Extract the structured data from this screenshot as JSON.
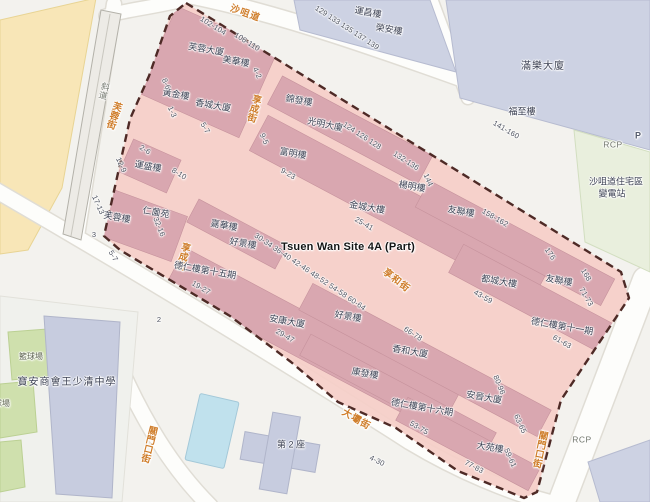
{
  "site": {
    "label": "Tsuen Wan Site 4A (Part)"
  },
  "colors": {
    "site_fill": "#f5cfc8",
    "site_parcel": "#d9a7b0",
    "site_border": "#4e2a26",
    "street_name": "#cf7d2a",
    "building_name": "#3d4254",
    "address_number": "#4e5360",
    "block_lavender": "#cdd2e3",
    "yellow_area": "#f8e6b7",
    "court_green": "#cfe0ad",
    "pool_blue": "#c0e1ed",
    "road_white": "#fdfdfb"
  },
  "labels": [
    {
      "n": "site-area-label",
      "t": "Tsuen Wan Site 4A (Part)",
      "x": 348,
      "y": 248,
      "r": 0,
      "c": "t"
    },
    {
      "n": "street-label-sha-tsui-road",
      "t": "沙咀道",
      "x": 245,
      "y": 14,
      "r": 20,
      "c": "s"
    },
    {
      "n": "street-label-fu-yung-street",
      "t": "芙蓉街",
      "x": 113,
      "y": 115,
      "r": 18,
      "c": "s",
      "v": true
    },
    {
      "n": "street-label-heung-shing-street-upper",
      "t": "享成街",
      "x": 253,
      "y": 108,
      "r": 15,
      "c": "s",
      "v": true
    },
    {
      "n": "street-label-heung-shing-street-lower",
      "t": "享成街",
      "x": 182,
      "y": 256,
      "r": 15,
      "c": "s",
      "v": true
    },
    {
      "n": "street-label-heung-wo-street",
      "t": "享和街",
      "x": 396,
      "y": 281,
      "r": 38,
      "c": "s"
    },
    {
      "n": "street-label-tai-pa-street",
      "t": "大壩街",
      "x": 356,
      "y": 420,
      "r": 30,
      "c": "s"
    },
    {
      "n": "street-label-kwan-mun-hau-street-west",
      "t": "關門口街",
      "x": 148,
      "y": 444,
      "r": 14,
      "c": "s",
      "v": true
    },
    {
      "n": "street-label-kwan-mun-hau-street-east",
      "t": "關門口街",
      "x": 539,
      "y": 449,
      "r": 12,
      "c": "s",
      "v": true
    },
    {
      "n": "building-label-fu-yung-mansion",
      "t": "芙蓉大廈",
      "x": 206,
      "y": 50,
      "r": 10,
      "c": "b"
    },
    {
      "n": "building-label-mei-wah-house",
      "t": "美華樓",
      "x": 236,
      "y": 62,
      "r": 10,
      "c": "b"
    },
    {
      "n": "building-label-wong-kam-house",
      "t": "黃金樓",
      "x": 176,
      "y": 95,
      "r": 10,
      "c": "b"
    },
    {
      "n": "building-label-heung-shing-mansion",
      "t": "香城大廈",
      "x": 213,
      "y": 106,
      "r": 10,
      "c": "b"
    },
    {
      "n": "building-label-kam-fat-house",
      "t": "錦發樓",
      "x": 299,
      "y": 101,
      "r": 10,
      "c": "b"
    },
    {
      "n": "building-label-kwong-ming-mansion",
      "t": "光明大廈",
      "x": 325,
      "y": 125,
      "r": 12,
      "c": "b"
    },
    {
      "n": "building-label-fu-ming-house",
      "t": "富明樓",
      "x": 293,
      "y": 154,
      "r": 10,
      "c": "b"
    },
    {
      "n": "building-label-yeung-ming-house",
      "t": "楊明樓",
      "x": 412,
      "y": 187,
      "r": 10,
      "c": "b"
    },
    {
      "n": "building-label-kam-shing-building",
      "t": "金城大樓",
      "x": 367,
      "y": 208,
      "r": 10,
      "c": "b"
    },
    {
      "n": "building-label-yau-luen-house-upper",
      "t": "友聯樓",
      "x": 461,
      "y": 212,
      "r": 10,
      "c": "b"
    },
    {
      "n": "building-label-to-shing-building",
      "t": "都城大樓",
      "x": 499,
      "y": 282,
      "r": 10,
      "c": "b"
    },
    {
      "n": "building-label-yau-luen-house-lower",
      "t": "友聯樓",
      "x": 559,
      "y": 281,
      "r": 10,
      "c": "b"
    },
    {
      "n": "building-label-tak-yan-phase-11",
      "t": "德仁樓第十一期",
      "x": 562,
      "y": 327,
      "r": 10,
      "c": "b"
    },
    {
      "n": "building-label-wan-shing-house",
      "t": "運盛樓",
      "x": 148,
      "y": 167,
      "r": 10,
      "c": "b"
    },
    {
      "n": "building-label-fu-yung-house",
      "t": "芙蓉樓",
      "x": 117,
      "y": 218,
      "r": 10,
      "c": "b"
    },
    {
      "n": "building-label-yan-yuen-court",
      "t": "仁薗苑",
      "x": 156,
      "y": 213,
      "r": 10,
      "c": "b"
    },
    {
      "n": "building-label-ka-wah-house",
      "t": "嘉華樓",
      "x": 224,
      "y": 226,
      "r": 10,
      "c": "b"
    },
    {
      "n": "building-label-ho-king-house-upper",
      "t": "好景樓",
      "x": 243,
      "y": 244,
      "r": 10,
      "c": "b"
    },
    {
      "n": "building-label-tak-yan-phase-15",
      "t": "德仁樓第十五期",
      "x": 205,
      "y": 271,
      "r": 10,
      "c": "b"
    },
    {
      "n": "building-label-on-hong-mansion",
      "t": "安康大廈",
      "x": 287,
      "y": 322,
      "r": 10,
      "c": "b"
    },
    {
      "n": "building-label-ho-king-house-lower",
      "t": "好景樓",
      "x": 348,
      "y": 317,
      "r": 10,
      "c": "b"
    },
    {
      "n": "building-label-heung-wo-mansion",
      "t": "香和大廈",
      "x": 410,
      "y": 352,
      "r": 10,
      "c": "b"
    },
    {
      "n": "building-label-hong-fat-house",
      "t": "康發樓",
      "x": 365,
      "y": 374,
      "r": 10,
      "c": "b"
    },
    {
      "n": "building-label-tak-yan-phase-16",
      "t": "德仁樓第十六期",
      "x": 422,
      "y": 408,
      "r": 10,
      "c": "b"
    },
    {
      "n": "building-label-on-chun-mansion",
      "t": "安晉大廈",
      "x": 484,
      "y": 398,
      "r": 10,
      "c": "b"
    },
    {
      "n": "building-label-tai-yuen-house",
      "t": "大苑樓",
      "x": 490,
      "y": 448,
      "r": 10,
      "c": "b"
    },
    {
      "n": "building-label-wan-cheong-house",
      "t": "運昌樓",
      "x": 368,
      "y": 13,
      "r": 10,
      "c": "b"
    },
    {
      "n": "building-label-wing-on-house",
      "t": "榮安樓",
      "x": 389,
      "y": 30,
      "r": 10,
      "c": "b"
    },
    {
      "n": "building-label-moon-lok-mansion",
      "t": "滿樂大廈",
      "x": 543,
      "y": 67,
      "r": 0,
      "c": "b bb"
    },
    {
      "n": "building-label-fuk-chi-house",
      "t": "福至樓",
      "x": 522,
      "y": 112,
      "r": 0,
      "c": "b"
    },
    {
      "n": "building-label-substation-line1",
      "t": "沙咀道住宅區",
      "x": 616,
      "y": 182,
      "r": 0,
      "c": "b"
    },
    {
      "n": "building-label-substation-line2",
      "t": "變電站",
      "x": 612,
      "y": 194,
      "r": 0,
      "c": "b"
    },
    {
      "n": "building-label-block-2",
      "t": "第 2 座",
      "x": 291,
      "y": 445,
      "r": 0,
      "c": "b"
    },
    {
      "n": "building-label-school",
      "t": "寶安商會王少清中學",
      "x": 67,
      "y": 383,
      "r": 0,
      "c": "b bb"
    },
    {
      "n": "court-label-basketball-1",
      "t": "籃球場",
      "x": 31,
      "y": 357,
      "r": 0,
      "c": "g2"
    },
    {
      "n": "court-label-basketball-2",
      "t": "籃球場",
      "x": -2,
      "y": 404,
      "r": 0,
      "c": "g2"
    },
    {
      "n": "ramp-label",
      "t": "斜道",
      "x": 104,
      "y": 91,
      "r": 15,
      "c": "g",
      "v": true
    },
    {
      "n": "rcp-label-top",
      "t": "RCP",
      "x": 613,
      "y": 145,
      "r": 0,
      "c": "g"
    },
    {
      "n": "parking-label",
      "t": "P",
      "x": 638,
      "y": 136,
      "r": 0,
      "c": "gp"
    },
    {
      "n": "rcp-label-bottom",
      "t": "RCP",
      "x": 582,
      "y": 440,
      "r": 0,
      "c": "g"
    },
    {
      "n": "road-label-2",
      "t": "2",
      "x": 159,
      "y": 320,
      "r": 0,
      "c": "n"
    },
    {
      "n": "addr-102-104",
      "t": "102-104",
      "x": 213,
      "y": 26,
      "r": 32,
      "c": "n"
    },
    {
      "n": "addr-106-110",
      "t": "106-110",
      "x": 247,
      "y": 42,
      "r": 32,
      "c": "n"
    },
    {
      "n": "addr-4-2",
      "t": "4-2",
      "x": 257,
      "y": 73,
      "r": 66,
      "c": "n"
    },
    {
      "n": "addr-8-6",
      "t": "8-6",
      "x": 166,
      "y": 84,
      "r": 66,
      "c": "n"
    },
    {
      "n": "addr-1-3",
      "t": "1-3",
      "x": 172,
      "y": 112,
      "r": 66,
      "c": "n"
    },
    {
      "n": "addr-5-7-upper",
      "t": "5-7",
      "x": 205,
      "y": 128,
      "r": 60,
      "c": "n"
    },
    {
      "n": "addr-2-6",
      "t": "2-6",
      "x": 145,
      "y": 150,
      "r": 30,
      "c": "n"
    },
    {
      "n": "addr-12-9",
      "t": "12-9",
      "x": 121,
      "y": 165,
      "r": 66,
      "c": "n"
    },
    {
      "n": "addr-8-10",
      "t": "8-10",
      "x": 179,
      "y": 174,
      "r": 32,
      "c": "n"
    },
    {
      "n": "addr-17-13",
      "t": "17-13",
      "x": 98,
      "y": 205,
      "r": 66,
      "c": "n"
    },
    {
      "n": "addr-9-5",
      "t": "9-5",
      "x": 264,
      "y": 139,
      "r": 66,
      "c": "n"
    },
    {
      "n": "addr-3",
      "t": "3",
      "x": 94,
      "y": 235,
      "r": 0,
      "c": "n"
    },
    {
      "n": "addr-5-7-lower",
      "t": "5-7",
      "x": 113,
      "y": 256,
      "r": 60,
      "c": "n"
    },
    {
      "n": "addr-32-16",
      "t": "32-16",
      "x": 159,
      "y": 227,
      "r": 68,
      "c": "n"
    },
    {
      "n": "addr-124-128-range",
      "t": "124 126 128",
      "x": 362,
      "y": 136,
      "r": 33,
      "c": "n"
    },
    {
      "n": "addr-132-136",
      "t": "132-136",
      "x": 406,
      "y": 161,
      "r": 33,
      "c": "n"
    },
    {
      "n": "addr-144",
      "t": "144",
      "x": 428,
      "y": 180,
      "r": 66,
      "c": "n"
    },
    {
      "n": "addr-9-23",
      "t": "9-23",
      "x": 288,
      "y": 174,
      "r": 30,
      "c": "n"
    },
    {
      "n": "addr-25-41",
      "t": "25-41",
      "x": 364,
      "y": 224,
      "r": 30,
      "c": "n"
    },
    {
      "n": "addr-158-162",
      "t": "158-162",
      "x": 495,
      "y": 218,
      "r": 30,
      "c": "n"
    },
    {
      "n": "addr-176",
      "t": "176",
      "x": 550,
      "y": 254,
      "r": 56,
      "c": "n"
    },
    {
      "n": "addr-168",
      "t": "168",
      "x": 586,
      "y": 275,
      "r": 60,
      "c": "n"
    },
    {
      "n": "addr-43-59",
      "t": "43-59",
      "x": 483,
      "y": 297,
      "r": 30,
      "c": "n"
    },
    {
      "n": "addr-71-73",
      "t": "71-73",
      "x": 586,
      "y": 297,
      "r": 60,
      "c": "n"
    },
    {
      "n": "addr-61-63",
      "t": "61-63",
      "x": 562,
      "y": 342,
      "r": 30,
      "c": "n"
    },
    {
      "n": "addr-80-96",
      "t": "80-96",
      "x": 499,
      "y": 385,
      "r": 68,
      "c": "n"
    },
    {
      "n": "addr-30-64-range",
      "t": "30-34 36-40 42-46 48-52 54-58 60-64",
      "x": 310,
      "y": 272,
      "r": 34,
      "c": "n"
    },
    {
      "n": "addr-19-27",
      "t": "19-27",
      "x": 201,
      "y": 288,
      "r": 30,
      "c": "n"
    },
    {
      "n": "addr-29-47",
      "t": "29-47",
      "x": 285,
      "y": 336,
      "r": 30,
      "c": "n"
    },
    {
      "n": "addr-66-78",
      "t": "66-78",
      "x": 413,
      "y": 334,
      "r": 33,
      "c": "n"
    },
    {
      "n": "addr-53-75",
      "t": "53-75",
      "x": 419,
      "y": 428,
      "r": 30,
      "c": "n"
    },
    {
      "n": "addr-77-83",
      "t": "77-83",
      "x": 474,
      "y": 467,
      "r": 28,
      "c": "n"
    },
    {
      "n": "addr-59-61",
      "t": "59-61",
      "x": 510,
      "y": 458,
      "r": 66,
      "c": "n"
    },
    {
      "n": "addr-63-65",
      "t": "63-65",
      "x": 520,
      "y": 424,
      "r": 66,
      "c": "n"
    },
    {
      "n": "addr-129-139-range",
      "t": "129 133 135 137 139",
      "x": 347,
      "y": 28,
      "r": 33,
      "c": "n"
    },
    {
      "n": "addr-141-160",
      "t": "141-160",
      "x": 506,
      "y": 130,
      "r": 30,
      "c": "n"
    },
    {
      "n": "addr-4-30",
      "t": "4-30",
      "x": 377,
      "y": 461,
      "r": 26,
      "c": "n"
    }
  ]
}
